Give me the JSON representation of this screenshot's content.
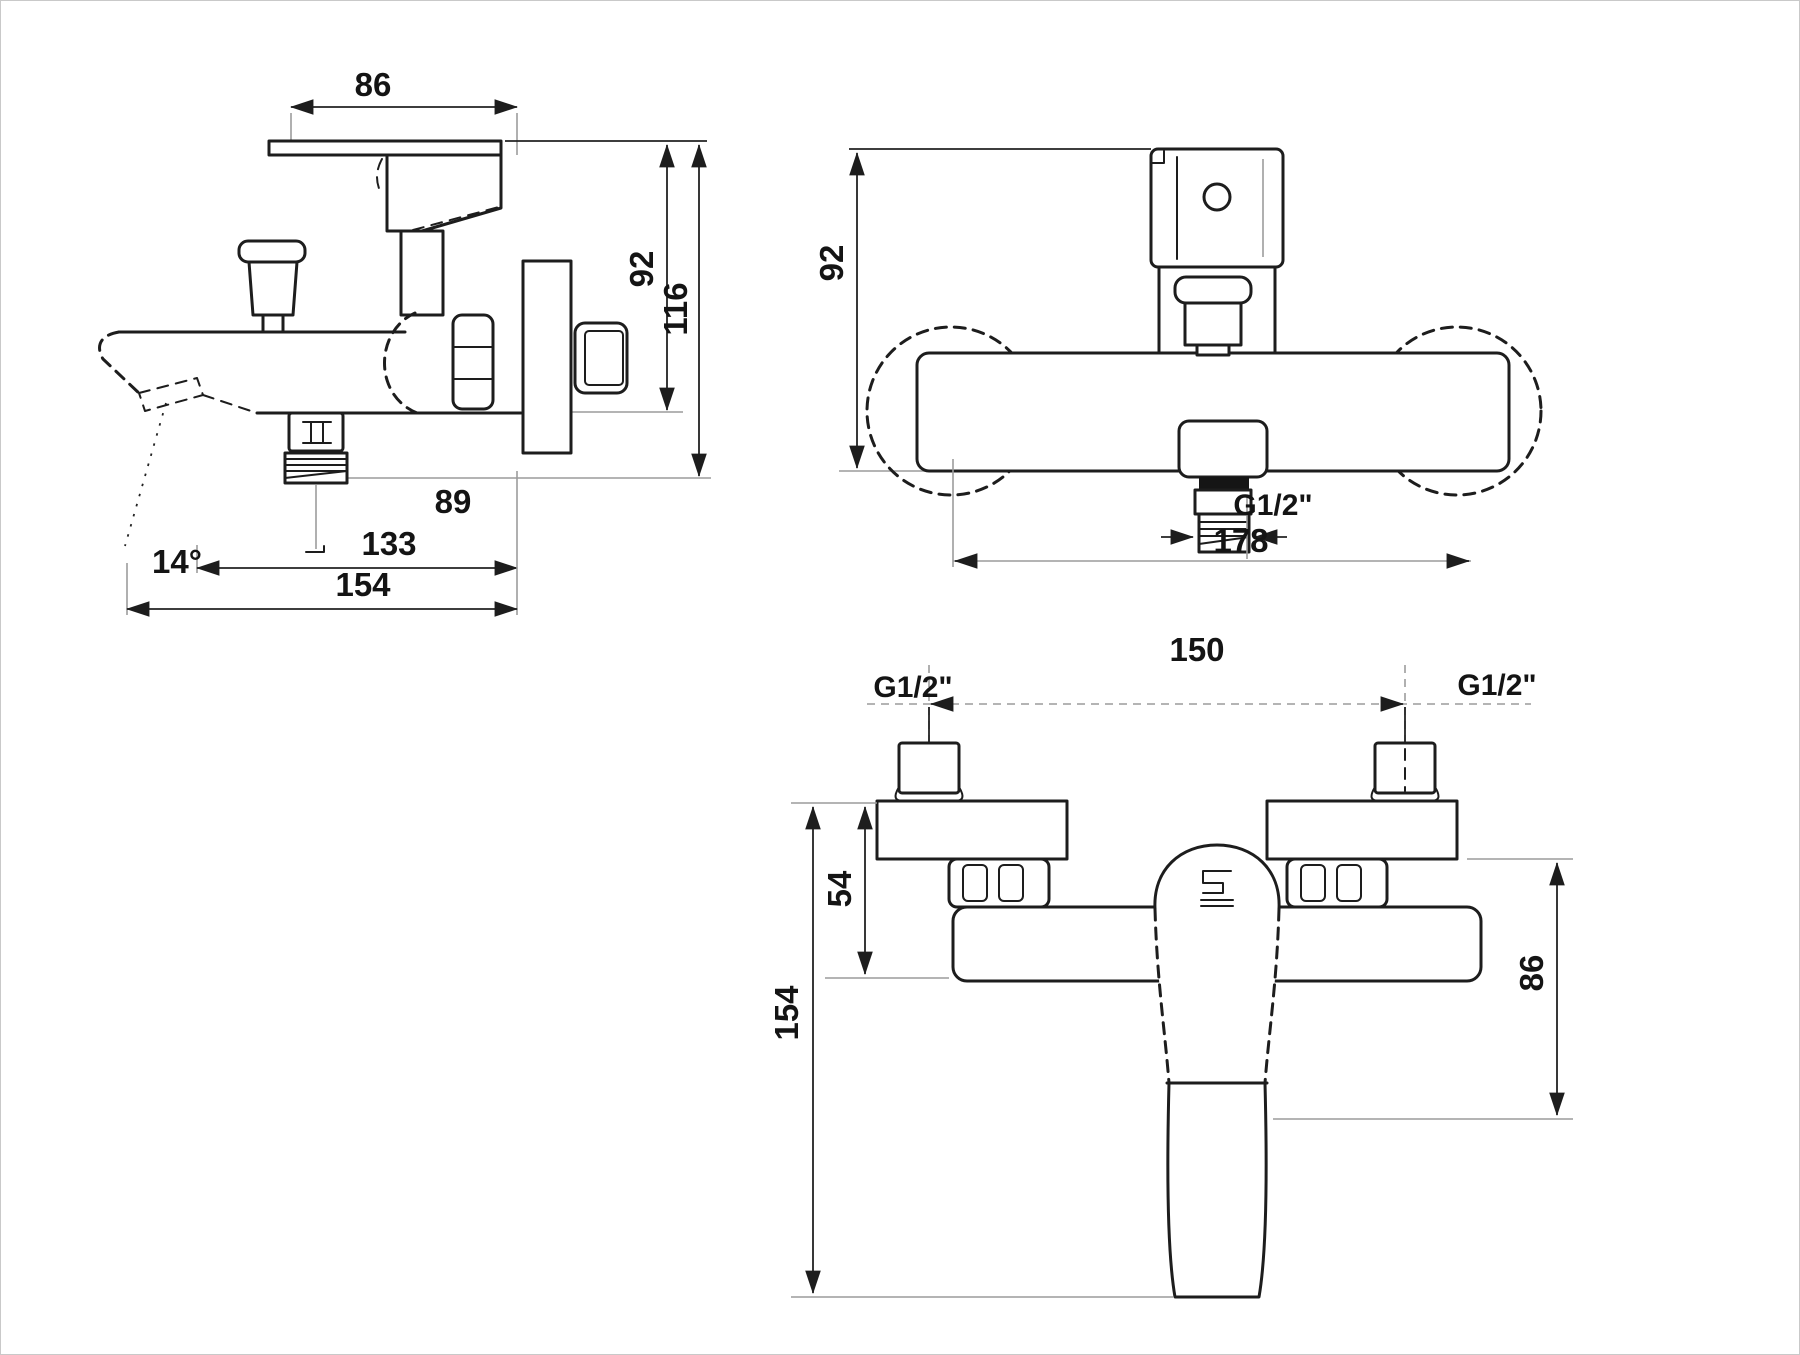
{
  "side_view": {
    "dim_top_width": "86",
    "dim_body_height": "92",
    "dim_total_height": "116",
    "dim_spout_outlet": "89",
    "dim_spout_length": "133",
    "dim_total_length": "154",
    "spout_angle": "14°"
  },
  "front_view": {
    "dim_height": "92",
    "thread_label": "G1/2\"",
    "dim_width": "178"
  },
  "bottom_view": {
    "dim_inlet_spacing": "150",
    "thread_left": "G1/2\"",
    "thread_right": "G1/2\"",
    "dim_flange_depth": "54",
    "dim_total_depth": "154",
    "dim_body_height": "86"
  },
  "line_color": "#1d1d1d",
  "extension_line_color": "#9c9c9c"
}
